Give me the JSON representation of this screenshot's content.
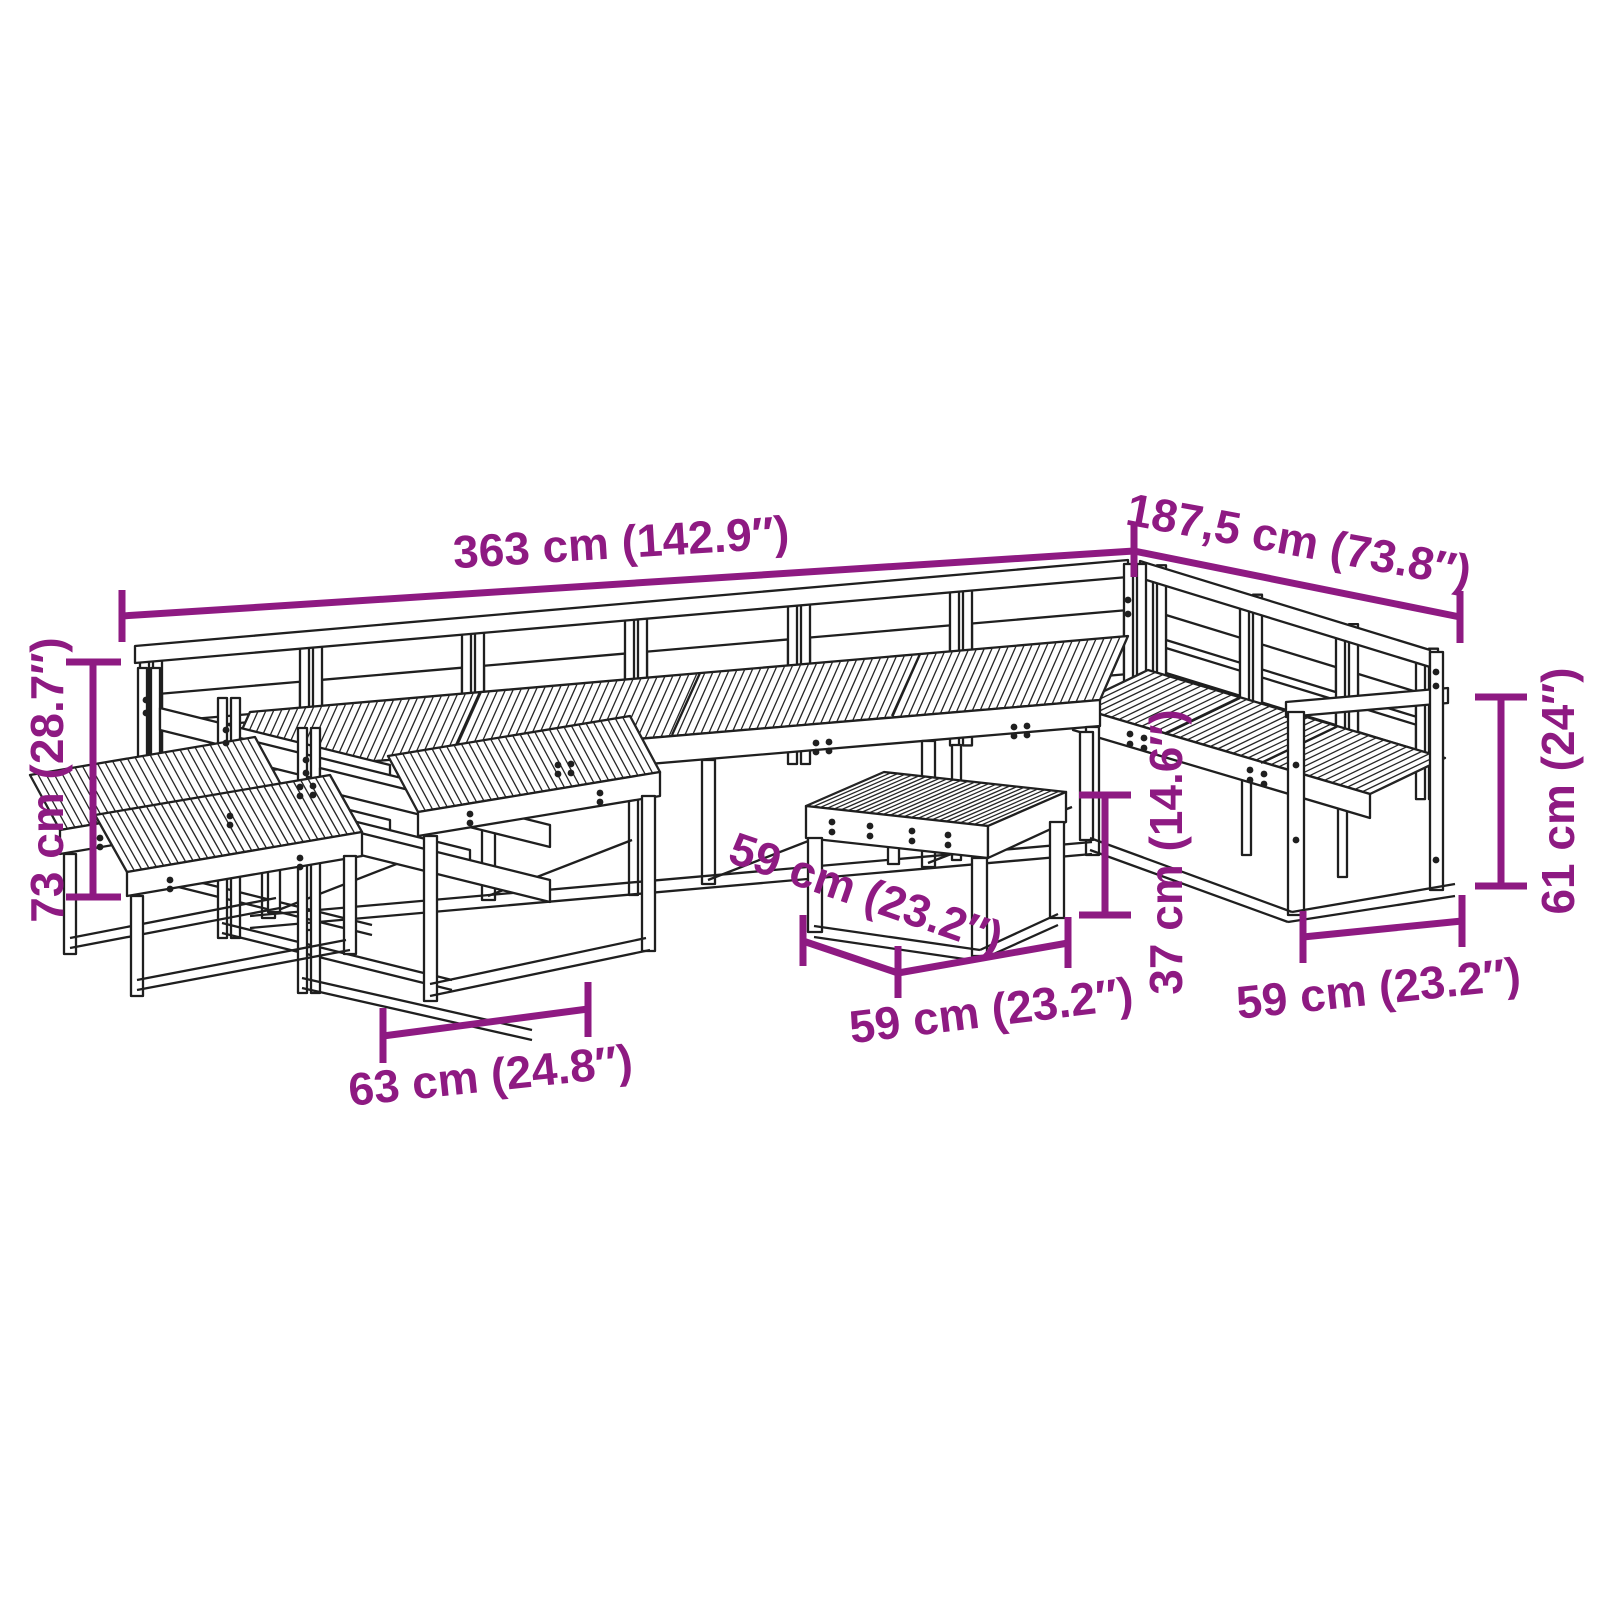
{
  "colors": {
    "annotation": "#8e1a82",
    "line_art": "#1f1f1f",
    "background": "#ffffff"
  },
  "dimensions": {
    "overall_width": "363 cm (142.9″)",
    "overall_depth": "187,5 cm (73.8″)",
    "overall_height": "73 cm (28.7″)",
    "left_module_depth": "63 cm (24.8″)",
    "table_depth": "59 cm (23.2″)",
    "table_width": "59 cm (23.2″)",
    "table_height": "37 cm (14.6″)",
    "armrest_height": "61 cm (24″)",
    "right_module_width": "59 cm (23.2″)"
  }
}
